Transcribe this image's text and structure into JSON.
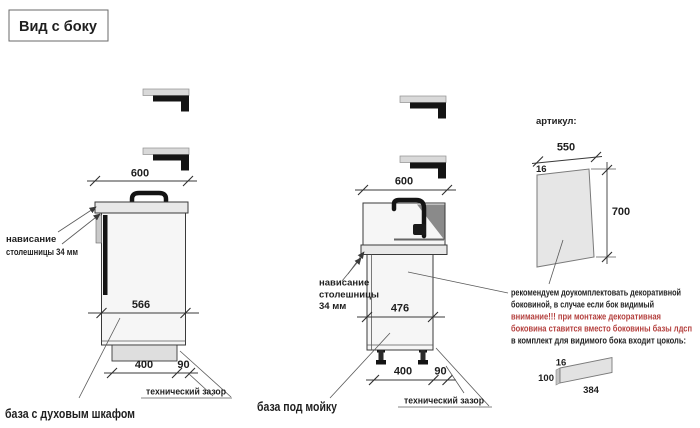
{
  "title": "Вид с боку",
  "left": {
    "dim_width": "600",
    "dim_inner": "566",
    "dim_plinth": "400",
    "dim_gap": "90",
    "overhang_line1": "нависание",
    "overhang_line2": "столешницы 34 мм",
    "gap_label": "технический зазор",
    "caption": "база с духовым шкафом"
  },
  "middle": {
    "dim_width": "600",
    "dim_inner": "476",
    "dim_plinth": "400",
    "dim_gap": "90",
    "overhang_line1": "нависание",
    "overhang_line2": "столешницы",
    "overhang_line3": "34 мм",
    "gap_label": "технический зазор",
    "caption": "база под мойку"
  },
  "right": {
    "articul": "артикул:",
    "panel_width": "550",
    "panel_thickness": "16",
    "panel_height": "700",
    "note_line1": "рекомендуем доукомплектовать декоративной",
    "note_line2": "боковиной, в случае если бок видимый",
    "note_line3": "внимание!!! при монтаже декоративная",
    "note_line4": "боковина ставится вместо боковины базы лдсп",
    "note_line5": "в комплект для видимого бока входит цоколь:",
    "plinth_thickness": "16",
    "plinth_height": "100",
    "plinth_length": "384"
  },
  "colors": {
    "warning_red": "#b4403e",
    "line": "#3a3a3a",
    "panel_fill": "#e8e8e8"
  }
}
